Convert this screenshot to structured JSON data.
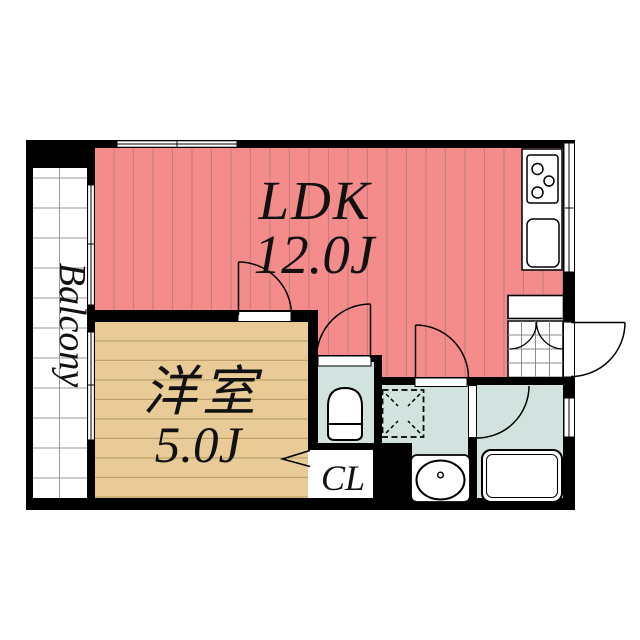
{
  "plan": {
    "type": "apartment-floor-plan",
    "rooms": {
      "ldk": {
        "label": "LDK",
        "area": "12.0J"
      },
      "western_room": {
        "label": "洋室",
        "area": "5.0J"
      },
      "closet": {
        "label": "CL"
      },
      "balcony": {
        "label": "Balcony"
      }
    },
    "fixtures": [
      "stove-icon",
      "kitchen-sink-icon",
      "toilet-icon",
      "washing-machine-pan-icon",
      "washbasin-icon",
      "faucet-icon",
      "bathtub-icon",
      "shoe-cabinet-icon",
      "entrance-tile",
      "front-door-swing",
      "interior-door-swings",
      "closet-open-arrow",
      "sliding-windows"
    ],
    "colors": {
      "ldk_fill": "#f58c8c",
      "ldk_stripe": "#c57d7d",
      "western_fill": "#e8cb96",
      "western_stripe": "#bda06b",
      "wet_area_fill": "#d2e2de",
      "wall": "#000000",
      "grid_line": "#9a9a9a",
      "background": "#ffffff"
    }
  }
}
